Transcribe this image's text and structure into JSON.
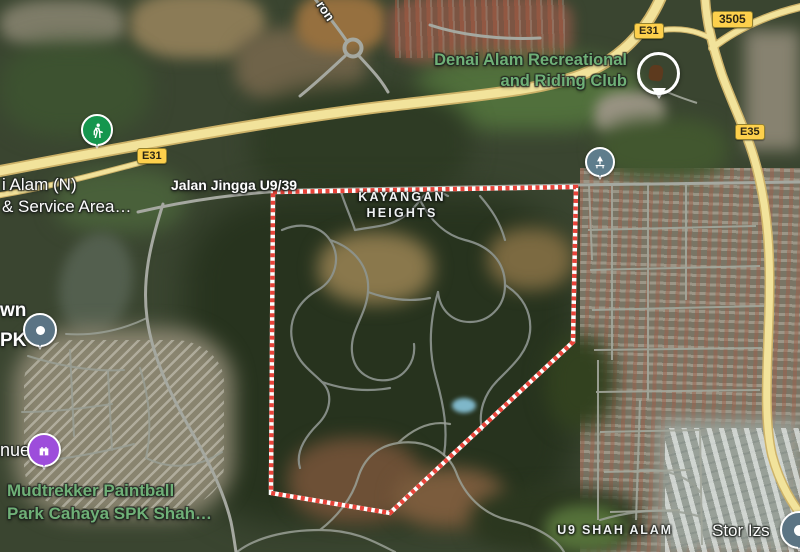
{
  "boundary": {
    "color": "#e8443a",
    "casing": "#ffffff"
  },
  "colors": {
    "highway_fill": "#f2e39b",
    "highway_casing": "#cdb268",
    "road_gray": "#a0a59b",
    "poi_green_text": "#6fb077",
    "map_label_white": "#fdfdfd"
  },
  "shields": {
    "e31": "E31",
    "e35": "E35",
    "r3505": "3505"
  },
  "labels": {
    "riding_club_1": "Denai Alam Recreational",
    "riding_club_2": "and Riding Club",
    "service_area_1": "i Alam (N)",
    "service_area_2": "& Service Area…",
    "jalan_jingga": "Jalan Jingga U9/39",
    "kayangan_1": "KAYANGAN",
    "kayangan_2": "HEIGHTS",
    "town_1": "wn",
    "town_2": "PK",
    "venue": "nue",
    "mudtrekker_1": "Mudtrekker Paintball",
    "mudtrekker_2": "Park Cahaya SPK Shah…",
    "u9_district": "U9 SHAH ALAM",
    "stor": "Stor Izs",
    "ron": "ron"
  },
  "markers": {
    "trailhead": {
      "color": "#15964e",
      "icon": "hiker-icon"
    },
    "park": {
      "color": "#5e7d8c",
      "icon": "tree-bench-icon"
    },
    "place_upper": {
      "color": "#5b7484",
      "icon": "dot"
    },
    "attraction": {
      "color": "#9d4ddb",
      "icon": "castle-icon"
    },
    "place_right": {
      "color": "#5b7484",
      "icon": "dot"
    },
    "riding_club_photo": {
      "name": "riding-club-photo"
    }
  }
}
